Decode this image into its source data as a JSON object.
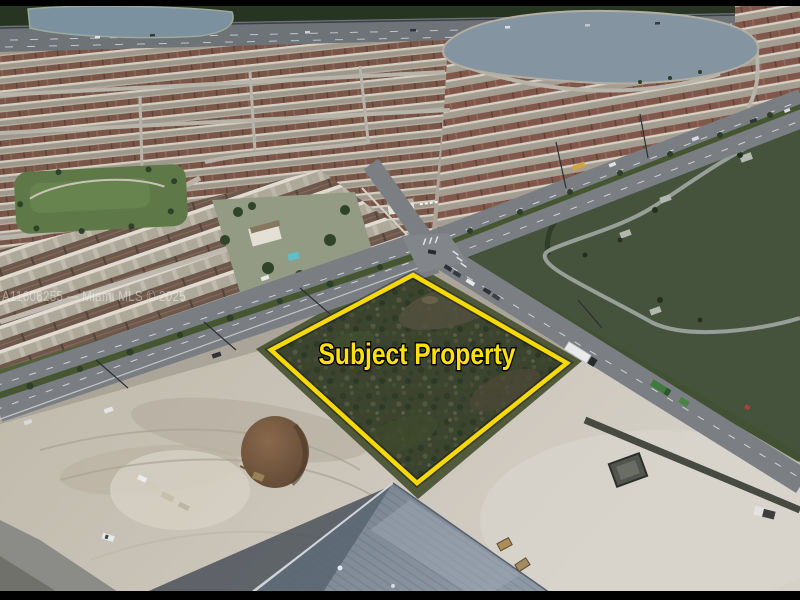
{
  "overlay": {
    "label": "Subject Property",
    "label_color": "#ffe10a",
    "outline_color": "#ffe100"
  },
  "watermark": {
    "text": "A11608255 — Miami MLS © 2025",
    "color": "#ffffff"
  },
  "frame": {
    "letterbox_color": "#000000"
  },
  "palette": {
    "lake": "#8799a5",
    "park_green": "#46543a",
    "scrub_green": "#3b442e",
    "sand": "#d3cdc0",
    "roof_brown": "#7d5748",
    "road_gray": "#7d8185",
    "warehouse_roof": "#8a96a2"
  }
}
